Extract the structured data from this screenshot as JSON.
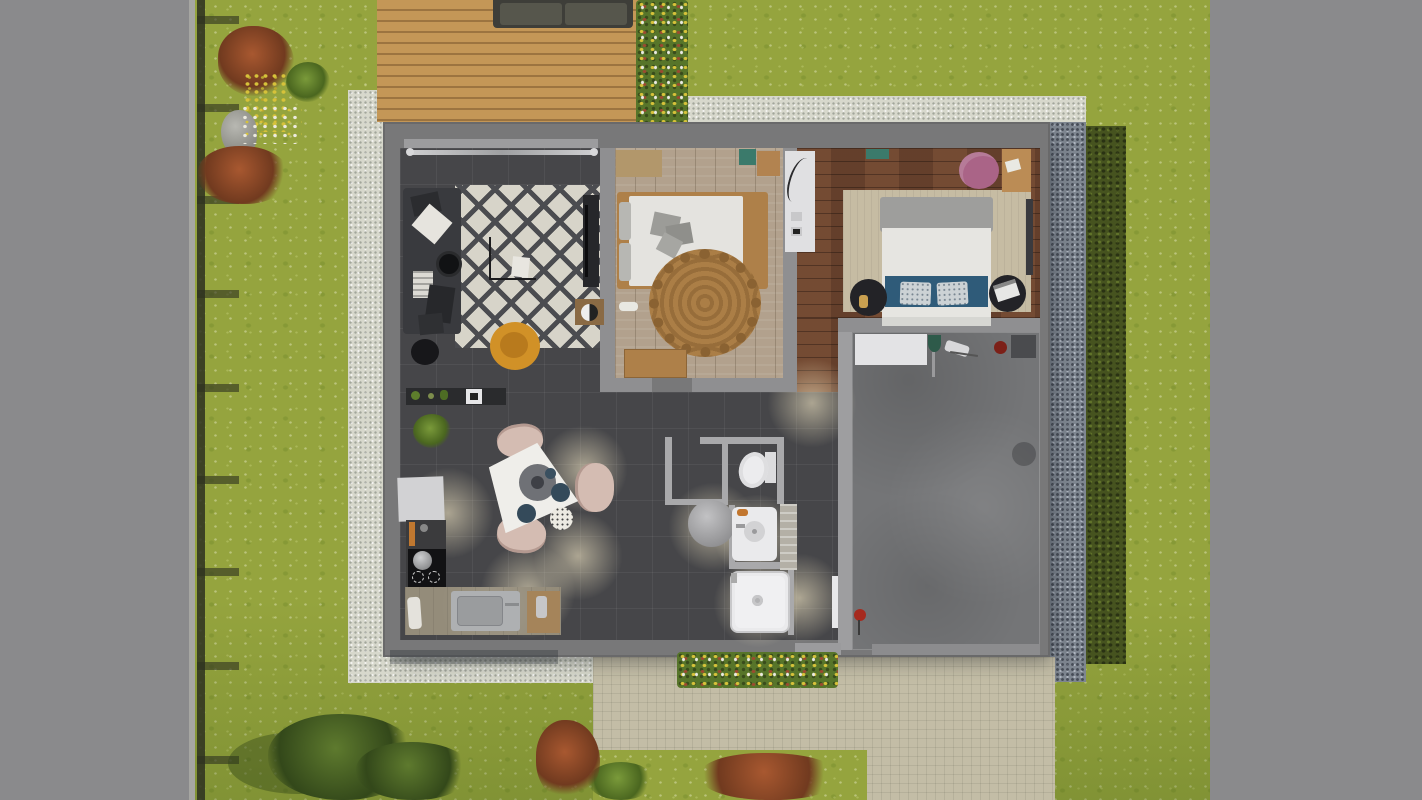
{
  "scene": {
    "type": "3d-floorplan-top-view",
    "description": "Top-down 3D architectural rendering of a single-storey house with furnished rooms, surrounded by a lawn, wooden deck, gravel border, hedge, fence and paved terrace"
  },
  "garden": {
    "lawn": "Lawn",
    "fence": "Garden fence with rail shadows",
    "curb": "Kerb line",
    "deck": "Wooden deck",
    "outdoor_sofa": "Outdoor sofa",
    "gravel_border": "White gravel border",
    "gravel_strip_right": "Dark gravel strip",
    "hedge": "Hedge",
    "terrace": "Paved terrace and driveway",
    "flower_bed_deck": "Deck-side flower bed",
    "flower_bed_front": "Front flower bed",
    "garden_cluster": "Left garden flower cluster",
    "stone": "Garden stone",
    "trees": "Garden trees and bushes"
  },
  "house": {
    "rooms": {
      "living_room": {
        "label": "Living room",
        "furniture": [
          "corner sofa",
          "diamond-pattern rug",
          "mustard armchair",
          "round side tables",
          "floor lamp",
          "TV unit",
          "media side table",
          "curtain rail"
        ]
      },
      "kitchen_dining": {
        "label": "Kitchen & dining",
        "furniture": [
          "kitchen counter with sink",
          "induction hob with pot",
          "fridge",
          "sideboard",
          "potted plant",
          "triangular dining table",
          "three chairs",
          "serving tray",
          "plates"
        ]
      },
      "bedroom_1": {
        "label": "Bedroom 1",
        "furniture": [
          "double bed",
          "round jute rug",
          "bench",
          "dresser",
          "nightstand",
          "teal wall shelf",
          "slippers"
        ]
      },
      "bedroom_2": {
        "label": "Bedroom 2",
        "furniture": [
          "double bed with blue runner",
          "area rug",
          "two round nightstands",
          "white wardrobe",
          "desk",
          "round mauve chair"
        ]
      },
      "hallway": {
        "label": "Hallway"
      },
      "wc": {
        "label": "WC",
        "furniture": [
          "toilet"
        ]
      },
      "bathroom": {
        "label": "Bathroom",
        "furniture": [
          "washbasin",
          "shower",
          "round laundry bin"
        ]
      },
      "garage": {
        "label": "Garage",
        "furniture": [
          "workbench",
          "broom",
          "floor mat",
          "fire extinguisher"
        ]
      }
    },
    "doors": {
      "front_door": "Front door",
      "garage_door": "Garage door",
      "entry_door_leaf": "Open interior door"
    }
  },
  "palette": {
    "pavement": "#8a8a8c",
    "grass": "#95a43e",
    "grass_dark": "#6e8a2c",
    "gravel_white": "#d7d8cc",
    "gravel_dark": "#7e8690",
    "hedge": "#46531f",
    "deck_wood": "#c49757",
    "deck_gap": "#9c7440",
    "wall": "#787879",
    "wall_inner": "#8f8f91",
    "wall_bath": "#a9a9ab",
    "floor_dark": "#464649",
    "wood_light": "#b2a18d",
    "wood_dark": "#6a432e",
    "concrete": "#747577",
    "terrace": "#c3bda6",
    "rug_white": "#d7d4c9",
    "rug_line": "#4b4c50",
    "sofa_dark": "#393a3e",
    "chair_yellow": "#d19127",
    "jute": "#ab7e46",
    "duvet": "#e4e3df",
    "bed_frame": "#ae8049",
    "rug_beige": "#c6bca3",
    "blue_accent": "#2f5b79",
    "chair_pink": "#aa6487",
    "desk_wood": "#bb8c55",
    "table_white": "#efeeea",
    "chair_blush": "#d4bcb2",
    "counter": "#948c7a",
    "steel": "#aeb0b2",
    "fixture_white": "#eaeaec",
    "red_accent": "#a62a1e",
    "teal_accent": "#3b7a6b",
    "foliage": "#4a661f",
    "bush_red": "#713a1f",
    "bush_light": "#a85830",
    "flower_yellow": "#d6c23a",
    "glow": "rgba(255,242,205,0.55)"
  }
}
